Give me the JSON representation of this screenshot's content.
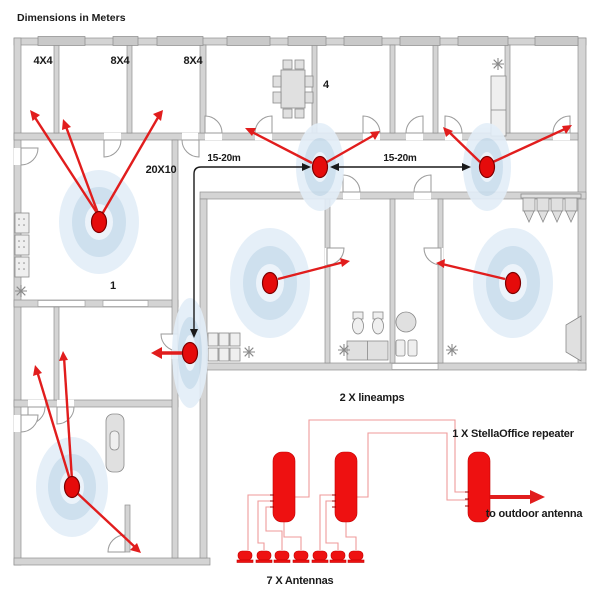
{
  "title": "Dimensions in Meters",
  "floorplan": {
    "rooms": [
      "4X4",
      "8X4",
      "8X4",
      "4",
      "20X10",
      "1"
    ],
    "distances": [
      "15-20m",
      "15-20m"
    ],
    "antenna_count": 7
  },
  "schematic": {
    "lineamps_label": "2 X lineamps",
    "repeater_label": "1 X StellaOffice repeater",
    "outdoor_label": "to outdoor antenna",
    "antennas_label": "7 X Antennas"
  },
  "colors": {
    "antenna_red": "#e50b0b",
    "arrow_red": "#e11d1d",
    "device_red": "#ee1111",
    "wire_red": "#ef9a9a",
    "ripple_outer": "#e3eef8",
    "ripple_mid": "#c9dded",
    "ripple_inner": "#eaf2fa",
    "wall_gray": "#d4d4d4"
  }
}
